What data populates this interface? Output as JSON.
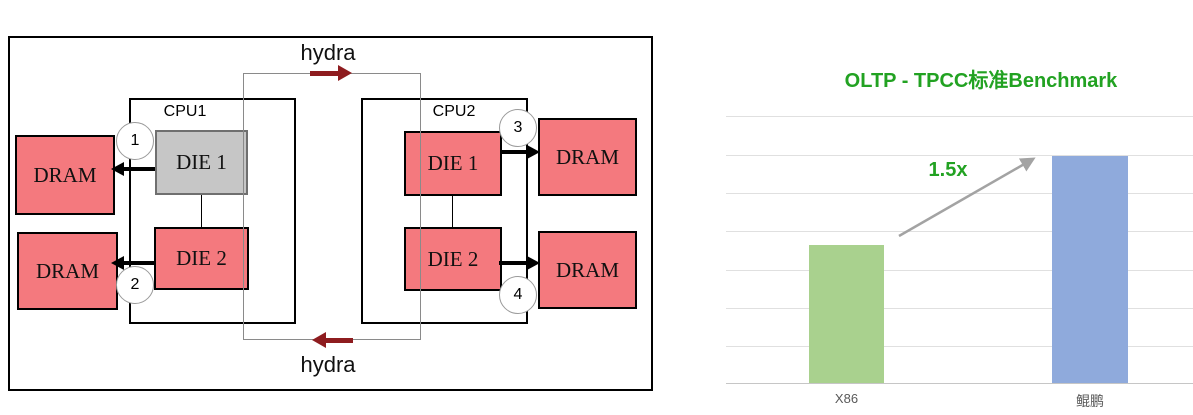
{
  "diagram": {
    "hydra_top": "hydra",
    "hydra_bottom": "hydra",
    "cpu1_label": "CPU1",
    "cpu2_label": "CPU2",
    "cpu1_die1": "DIE 1",
    "cpu1_die2": "DIE 2",
    "cpu2_die1": "DIE 1",
    "cpu2_die2": "DIE 2",
    "dram_labels": [
      "DRAM",
      "DRAM",
      "DRAM",
      "DRAM"
    ],
    "markers": [
      "1",
      "2",
      "3",
      "4"
    ],
    "colors": {
      "dram_fill": "#F4797E",
      "cpu1_die1_fill": "#C6C6C6",
      "hydra_arrow": "#8E1C1F",
      "memory_arrow": "#000000",
      "loop_line": "#8A8A8A"
    }
  },
  "chart_data": {
    "type": "bar",
    "title": "OLTP - TPCC标准Benchmark",
    "categories": [
      "X86",
      "鲲鹏"
    ],
    "values": [
      1,
      1.5
    ],
    "annotation": "1.5x",
    "bar_colors": [
      "#A9D18E",
      "#8FAADC"
    ],
    "title_color": "#22A222",
    "annotation_color": "#22A222",
    "label_color": "#595959",
    "xlabel": "",
    "ylabel": "",
    "gridlines": 8,
    "legend": false,
    "layout": {
      "bar_heights_px": [
        138,
        227
      ],
      "baseline_y_px": 383
    }
  }
}
